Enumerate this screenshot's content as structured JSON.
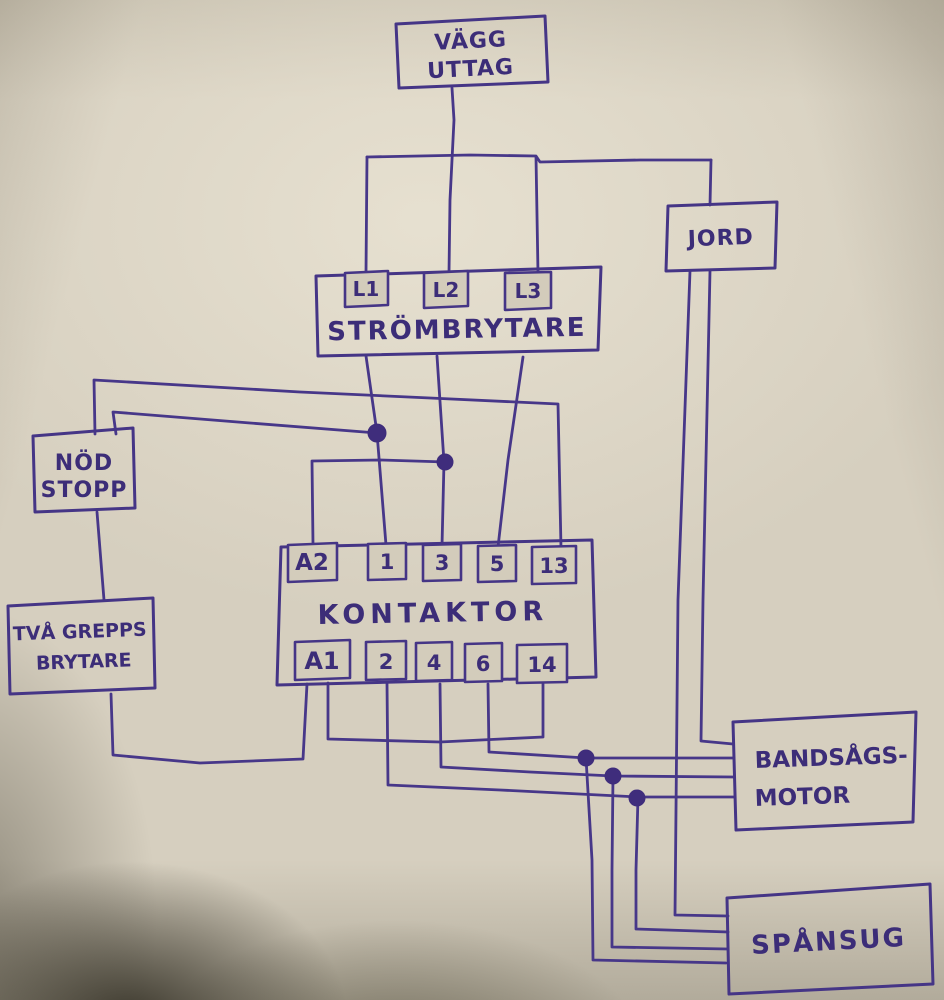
{
  "colors": {
    "ink": "#473789",
    "paper": "#d6cfbf",
    "junction_dot": "#3f2d7c"
  },
  "boxes": {
    "vagg_uttag": {
      "line1": "VÄGG",
      "line2": "UTTAG"
    },
    "strombrytare": {
      "label": "STRÖMBRYTARE",
      "terminals": {
        "l1": "L1",
        "l2": "L2",
        "l3": "L3"
      }
    },
    "jord": {
      "label": "JORD"
    },
    "nod_stopp": {
      "line1": "NÖD",
      "line2": "STOPP"
    },
    "tva_grepps": {
      "line1": "TVÅ GREPPS",
      "line2": "BRYTARE"
    },
    "kontaktor": {
      "label": "KONTAKTOR",
      "top_terminals": {
        "a2": "A2",
        "t1": "1",
        "t3": "3",
        "t5": "5",
        "t13": "13"
      },
      "bottom_terminals": {
        "a1": "A1",
        "t2": "2",
        "t4": "4",
        "t6": "6",
        "t14": "14"
      }
    },
    "bandsags_motor": {
      "line1": "BANDSÅGS-",
      "line2": "MOTOR"
    },
    "spansug": {
      "label": "SPÅNSUG"
    }
  },
  "connections": [
    {
      "from": "VÄGG UTTAG",
      "to": "STRÖMBRYTARE L1"
    },
    {
      "from": "VÄGG UTTAG",
      "to": "STRÖMBRYTARE L2"
    },
    {
      "from": "VÄGG UTTAG",
      "to": "STRÖMBRYTARE L3"
    },
    {
      "from": "VÄGG UTTAG",
      "to": "JORD"
    },
    {
      "from": "STRÖMBRYTARE L1",
      "to": "KONTAKTOR 1"
    },
    {
      "from": "STRÖMBRYTARE L2",
      "to": "KONTAKTOR 3"
    },
    {
      "from": "STRÖMBRYTARE L3",
      "to": "KONTAKTOR 5"
    },
    {
      "from": "L1-1 wire junction dot",
      "to": "NÖD STOPP"
    },
    {
      "from": "NÖD STOPP",
      "to": "KONTAKTOR 13"
    },
    {
      "from": "L2-3 wire junction dot",
      "to": "KONTAKTOR A2"
    },
    {
      "from": "NÖD STOPP",
      "to": "TVÅ GREPPS BRYTARE"
    },
    {
      "from": "TVÅ GREPPS BRYTARE",
      "to": "KONTAKTOR A1"
    },
    {
      "from": "KONTAKTOR A1",
      "to": "KONTAKTOR 14"
    },
    {
      "from": "KONTAKTOR 2",
      "to": "BANDSÅGS-MOTOR"
    },
    {
      "from": "KONTAKTOR 4",
      "to": "BANDSÅGS-MOTOR"
    },
    {
      "from": "KONTAKTOR 6",
      "to": "BANDSÅGS-MOTOR"
    },
    {
      "from": "JORD",
      "to": "BANDSÅGS-MOTOR"
    },
    {
      "from": "KONTAKTOR 2 wire junction dot",
      "to": "SPÅNSUG"
    },
    {
      "from": "KONTAKTOR 4 wire junction dot",
      "to": "SPÅNSUG"
    },
    {
      "from": "KONTAKTOR 6 wire junction dot",
      "to": "SPÅNSUG"
    },
    {
      "from": "JORD",
      "to": "SPÅNSUG"
    }
  ]
}
